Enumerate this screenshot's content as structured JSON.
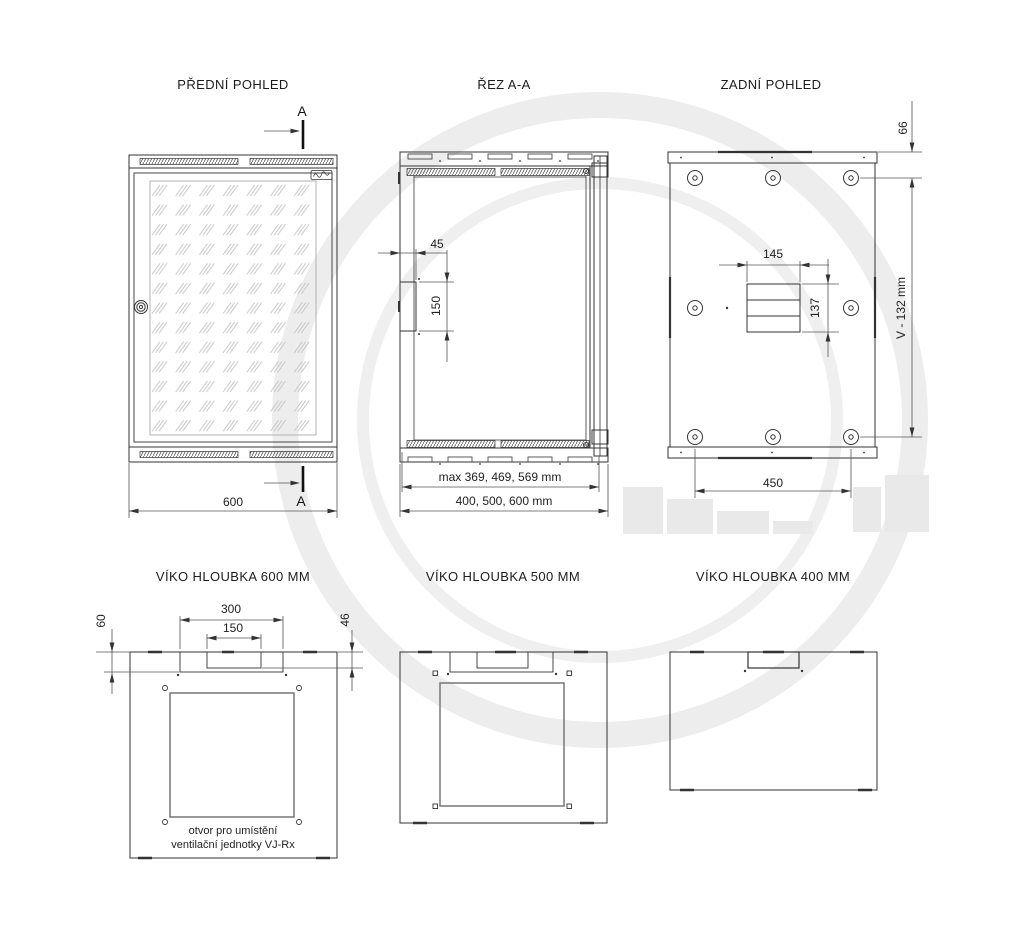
{
  "line_color": "#333333",
  "watermark_color": "#ededed",
  "views": {
    "front": {
      "title": "PŘEDNÍ POHLED",
      "section_label_top": "A",
      "section_label_bottom": "A",
      "dim_width": "600"
    },
    "section": {
      "title": "ŘEZ A-A",
      "dim_notch_depth": "45",
      "dim_notch_height": "150",
      "dim_depth_inner": "max 369, 469, 569 mm",
      "dim_depth_outer": "400, 500, 600 mm"
    },
    "rear": {
      "title": "ZADNÍ POHLED",
      "dim_top_offset": "66",
      "dim_height": "V - 132 mm",
      "dim_cable_width": "145",
      "dim_cable_height": "137",
      "dim_hole_spacing": "450"
    },
    "lid600": {
      "title": "VÍKO HLOUBKA 600 MM",
      "dim_cutout_outer": "300",
      "dim_cutout_inner": "150",
      "dim_depth_left": "60",
      "dim_depth_right": "46",
      "note_line1": "otvor pro umístění",
      "note_line2": "ventilační jednotky VJ-Rx"
    },
    "lid500": {
      "title": "VÍKO HLOUBKA 500 MM"
    },
    "lid400": {
      "title": "VÍKO HLOUBKA 400 MM"
    }
  }
}
